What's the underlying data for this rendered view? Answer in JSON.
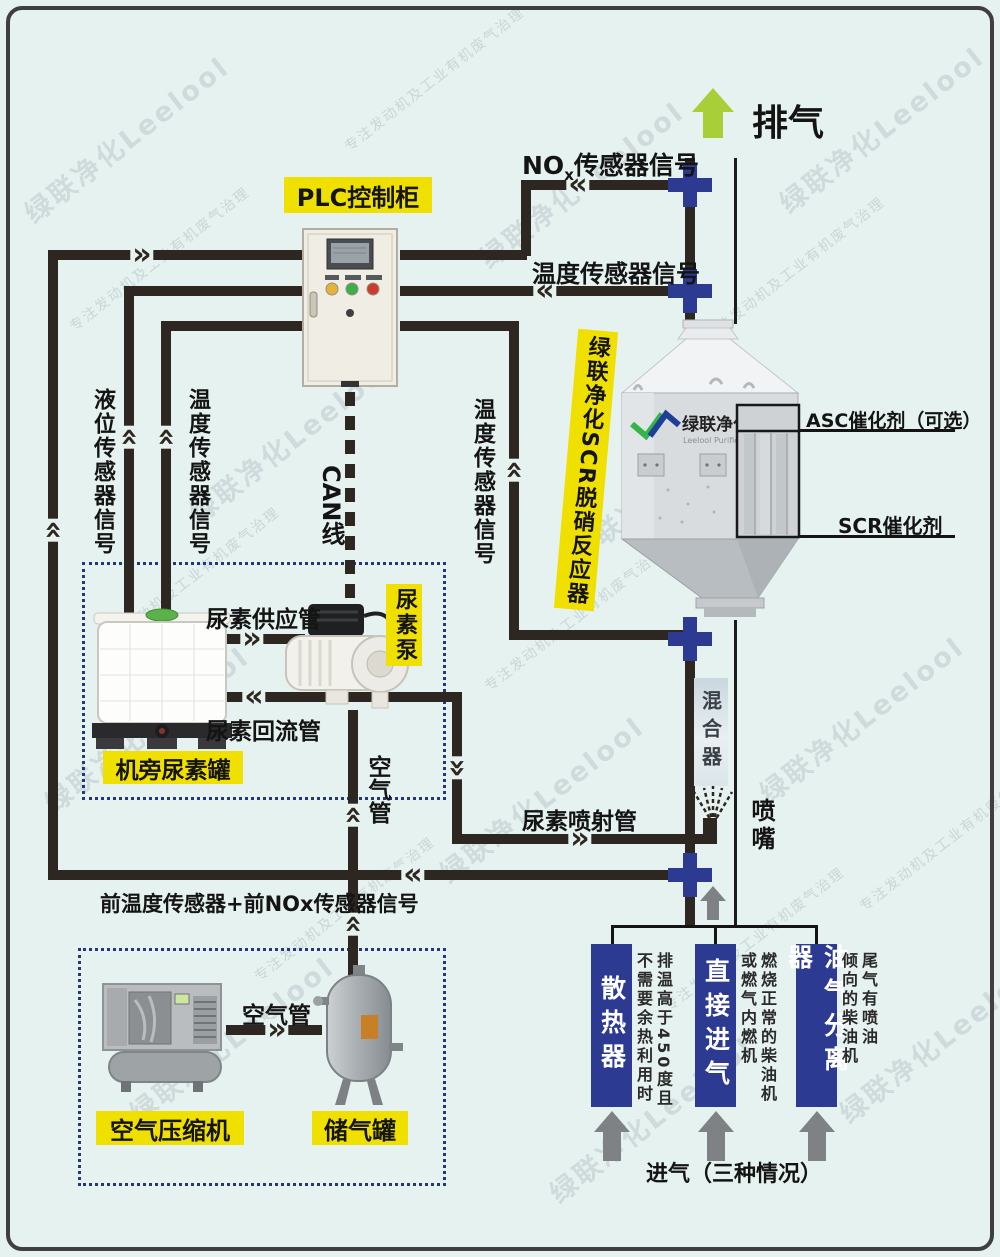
{
  "colors": {
    "background": "#e6f2ef",
    "accent_yellow": "#f0e000",
    "deep_blue": "#2c3a92",
    "pipe_black": "#2e2721",
    "lime_green": "#a8ce38",
    "gray_arrow": "#7e8285"
  },
  "watermark": {
    "brand": "绿联净化Leelool",
    "slogan": "专注发动机及工业有机废气治理"
  },
  "header": {
    "exhaust": "排气"
  },
  "plc": {
    "label": "PLC控制柜"
  },
  "signals": {
    "nox_prefix": "NO",
    "nox_sub": "x",
    "nox_suffix": "传感器信号",
    "temp_right": "温度传感器信号",
    "temp_mid": "温度传感器信号",
    "level_left": "液位传感器信号",
    "temp_left": "温度传感器信号",
    "can": "CAN线",
    "front_combined": "前温度传感器+前NOx传感器信号"
  },
  "urea": {
    "supply_pipe": "尿素供应管",
    "return_pipe": "尿素回流管",
    "pump": "尿素泵",
    "tank": "机旁尿素罐",
    "injection_pipe": "尿素喷射管",
    "air_pipe": "空气管"
  },
  "reactor": {
    "side_label": "绿联净化SCR脱硝反应器",
    "asc": "ASC催化剂（可选）",
    "scr": "SCR催化剂",
    "logo_cn": "绿联净化",
    "logo_en": "Leelool Purifier",
    "mixer": "混合器",
    "nozzle": "喷嘴"
  },
  "intake": {
    "sources": [
      {
        "label": "散热器",
        "note_cols": [
          "排温高于450度且",
          "不需要余热利用时"
        ]
      },
      {
        "label": "直接进气",
        "note_cols": [
          "燃烧正常的柴油机",
          "或燃气内燃机"
        ]
      },
      {
        "label": "油气分离器",
        "note_cols": [
          "尾气有喷油",
          "倾向的柴油机"
        ]
      }
    ],
    "caption": "进气（三种情况）"
  },
  "air": {
    "compressor": "空气压缩机",
    "tank": "储气罐",
    "pipe": "空气管"
  }
}
